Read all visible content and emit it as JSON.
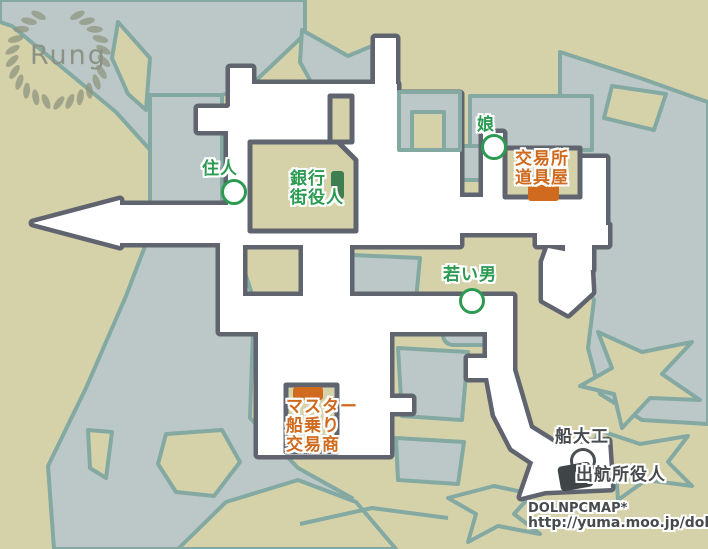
{
  "town": {
    "name": "Rung"
  },
  "labels": {
    "resident": {
      "lines": [
        "住人"
      ]
    },
    "bank": {
      "lines": [
        "銀行",
        "街役人"
      ]
    },
    "daughter": {
      "lines": [
        "娘"
      ]
    },
    "trade_shop": {
      "lines": [
        "交易所",
        "道具屋"
      ]
    },
    "young_man": {
      "lines": [
        "若い男"
      ]
    },
    "master": {
      "lines": [
        "マスター",
        "船乗り",
        "交易商"
      ]
    },
    "shipwright": {
      "lines": [
        "船大工"
      ]
    },
    "departure_official": {
      "lines": [
        "出航所役人"
      ]
    }
  },
  "credit": {
    "site": "DOLNPCMAP*",
    "url": "http://yuma.moo.jp/dolnpc/"
  },
  "colors": {
    "land": "#d5d2aa",
    "water": "#bcc8c7",
    "water_stroke": "#84a9a2",
    "street": "#ffffff",
    "street_stroke": "#5f646e",
    "npc_green": "#2b9b52",
    "npc_orange": "#d06a1f",
    "npc_dark": "#474b4e",
    "marker_green": "#3e7e51",
    "marker_orange": "#d06a1f",
    "marker_dark": "#3f4447",
    "logo_gray": "#8b9184"
  }
}
